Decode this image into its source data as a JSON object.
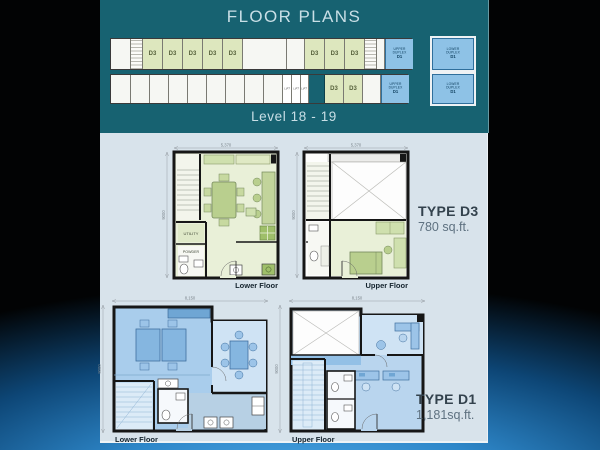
{
  "slide": {
    "title": "FLOOR PLANS",
    "level_label": "Level 18 - 19"
  },
  "building_strip": {
    "d3_label": "D3",
    "lift_label": "LIFT",
    "upper_duplex": {
      "l1": "UPPER",
      "l2": "DUPLEX",
      "l3": "D1"
    },
    "lower_duplex": {
      "l1": "LOWER",
      "l2": "DUPLEX",
      "l3": "D1"
    }
  },
  "plans": {
    "d3_lower": {
      "floor_label": "Lower Floor",
      "width_dim": "5,370",
      "height_dim": "9000",
      "utility_label": "UTILITY",
      "powder_label": "POWDER"
    },
    "d3_upper": {
      "floor_label": "Upper Floor",
      "width_dim": "5,370",
      "height_dim": "9000"
    },
    "d1_lower": {
      "floor_label": "Lower Floor",
      "width_dim": "8,150",
      "height_dim": "9000"
    },
    "d1_upper": {
      "floor_label": "Upper Floor",
      "width_dim": "8,150",
      "height_dim": "9000"
    }
  },
  "unit_types": {
    "d3": {
      "name": "TYPE D3",
      "area": "780 sq.ft."
    },
    "d1": {
      "name": "TYPE D1",
      "area": "1,181sq.ft."
    }
  },
  "colors": {
    "header_teal": "#176271",
    "panel_bg": "#d8e3eb",
    "unit_green": "#dde7be",
    "unit_blue": "#8ec2e6",
    "title_text": "#c9dfe6",
    "background_blue_glow": "#2e87c9"
  }
}
